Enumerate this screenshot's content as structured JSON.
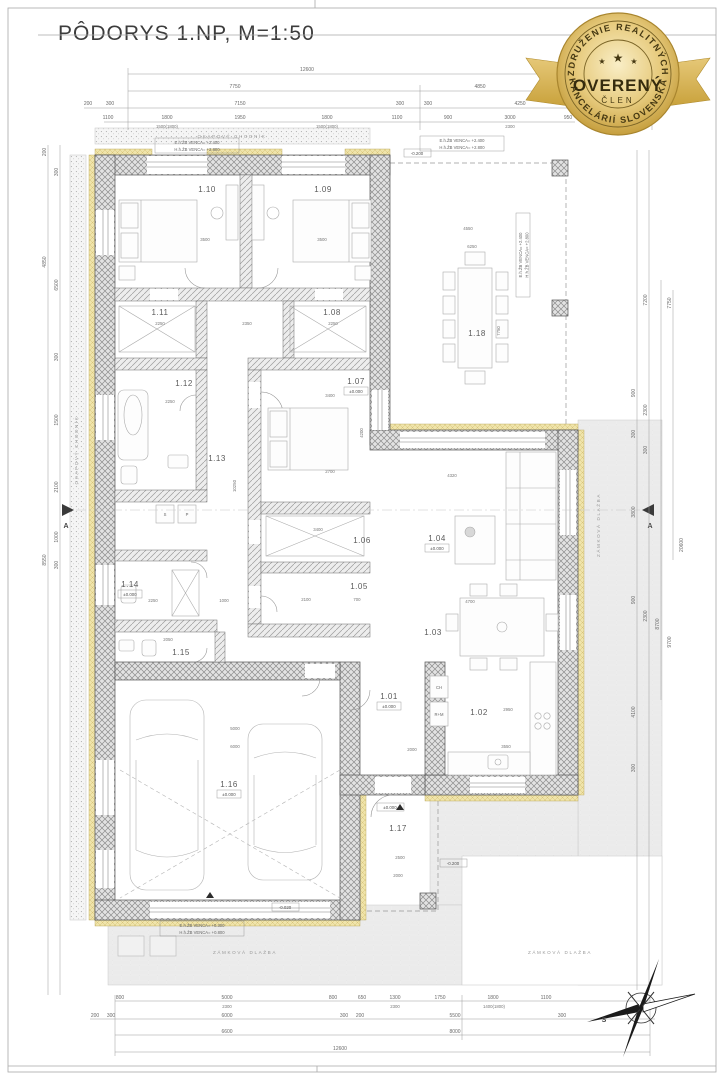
{
  "title": "PÔDORYS 1.NP, M=1:50",
  "badge": {
    "arc_top": "ZDRUŽENIE REALITNÝCH",
    "name": "OVERENÝ",
    "member": "ČLEN",
    "arc_bottom": "KANCELÁRIÍ SLOVENSKA",
    "star": "★",
    "colors": {
      "gold": "#c9a23c",
      "gold_light": "#f7ecc2",
      "text": "#453812"
    }
  },
  "rooms": {
    "n01": "1.01",
    "n02": "1.02",
    "n03": "1.03",
    "n04": "1.04",
    "n05": "1.05",
    "n06": "1.06",
    "n07": "1.07",
    "n08": "1.08",
    "n09": "1.09",
    "n10": "1.10",
    "n11": "1.11",
    "n12": "1.12",
    "n13": "1.13",
    "n14": "1.14",
    "n15": "1.15",
    "n16": "1.16",
    "n17": "1.17",
    "n18": "1.18"
  },
  "levels": {
    "zero": "±0.000",
    "m020": "-0.020",
    "m200": "-0.200"
  },
  "notes": {
    "venca_e": "E.h.ŽB VENCA= +2.400",
    "venca_h": "H.h.ŽB VENCA= +2.800",
    "venca_e2": "E.h.ŽB VENCA= +0.300",
    "venca_h2": "H.h.ŽB VENCA= +0.800",
    "paving": "ZÁMKOVÁ DLAŽBA",
    "walkway": "OKAPOVÝ CHODNÍK",
    "fridge": "CH",
    "pantry": "R+M",
    "washer": "S",
    "dryer": "P",
    "section": "A",
    "north": "S"
  },
  "dims": {
    "t1": "12600",
    "t2": [
      "7750",
      "4850"
    ],
    "t3": [
      "200",
      "300",
      "7150",
      "300",
      "300",
      "4250",
      "300"
    ],
    "t4": [
      "1100",
      "1800",
      "1950",
      "1800",
      "1100",
      "900",
      "3000",
      "950"
    ],
    "t5": [
      "1500(1800)",
      "1500(1800)",
      "2300"
    ],
    "b1": [
      "800",
      "5000",
      "800",
      "650",
      "1300",
      "1750",
      "1800",
      "1100"
    ],
    "b2": [
      "2300",
      "2300",
      "1400(1800)"
    ],
    "b3": [
      "200",
      "300",
      "6000",
      "300",
      "200",
      "5500",
      "300"
    ],
    "b4": [
      "6600",
      "8000"
    ],
    "b5": "12600",
    "l": [
      "200",
      "300",
      "4850",
      "6500",
      "300",
      "1500",
      "2100",
      "8550",
      "1000",
      "300"
    ],
    "r": [
      "7200",
      "7750",
      "900",
      "2300",
      "300",
      "300",
      "3800",
      "20600",
      "900",
      "2300",
      "8700",
      "9700",
      "4100",
      "300"
    ],
    "i": [
      "3500",
      "3500",
      "2250",
      "2250",
      "2350",
      "2250",
      "3400",
      "4200",
      "2700",
      "3400",
      "2100",
      "700",
      "4320",
      "4700",
      "2950",
      "3550",
      "5000",
      "6000",
      "2500",
      "2000",
      "2000",
      "2250",
      "1000",
      "2050",
      "10250",
      "4550",
      "6250",
      "7750"
    ]
  }
}
